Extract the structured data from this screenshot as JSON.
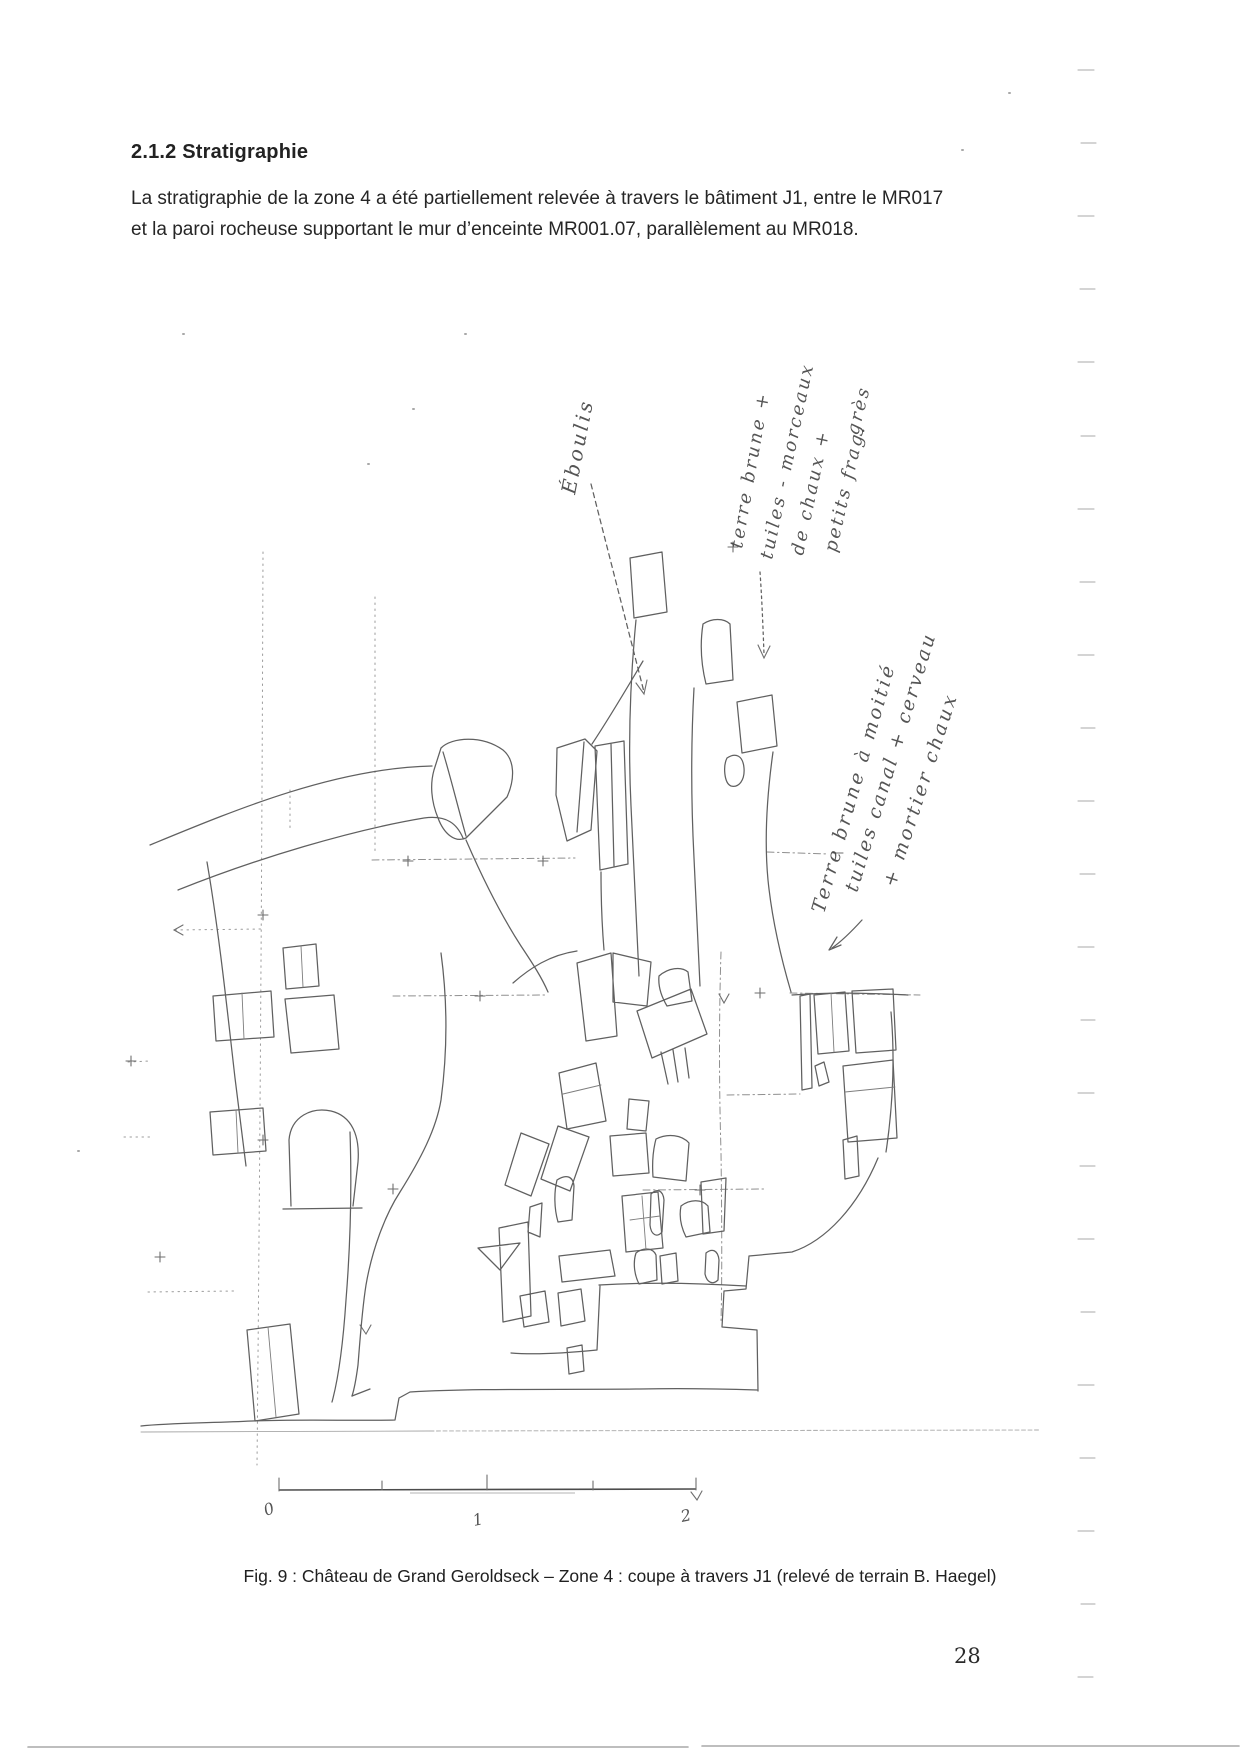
{
  "document": {
    "section_heading": "2.1.2 Stratigraphie",
    "paragraph_lines": [
      "La stratigraphie de la zone 4 a été partiellement relevée à travers le bâtiment J1, entre le MR017",
      "et la paroi rocheuse supportant le mur d’enceinte MR001.07, parallèlement au MR018."
    ],
    "page_number": "28"
  },
  "figure": {
    "caption": "Fig. 9 : Château de Grand Geroldseck – Zone 4 : coupe à travers J1 (relevé de terrain B. Haegel)",
    "annotations": {
      "eboulis": "Éboulis",
      "upper_layer_lines": [
        "terre brune +",
        "tuiles - morceaux",
        "de chaux +",
        "petits frag.",
        "grès"
      ],
      "lower_layer_lines": [
        "Terre brune à moitié",
        "tuiles canal + cerveau",
        "+ mortier chaux"
      ]
    },
    "scale_labels": [
      "0",
      "1",
      "2"
    ],
    "pencil_color": "#606060",
    "ink_color": "#3e3e3e"
  }
}
